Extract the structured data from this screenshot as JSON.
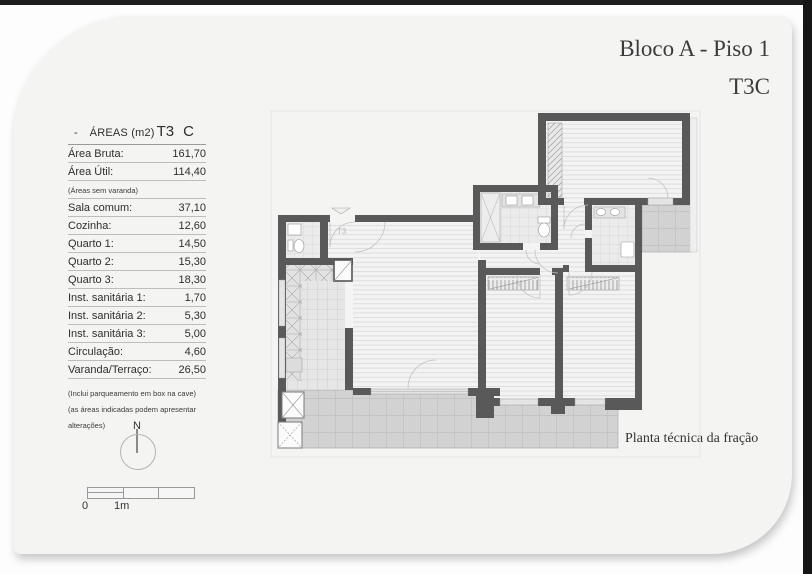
{
  "page": {
    "title_line1": "Bloco A - Piso 1",
    "title_line2": "T3C",
    "plan_caption": "Planta técnica da fração"
  },
  "areas": {
    "dash": "-",
    "header_label": "ÁREAS (m2)",
    "header_type": "T3",
    "header_variant": "C",
    "rows": [
      {
        "label": "Área Bruta:",
        "value": "161,70"
      },
      {
        "label": "Área Útil:",
        "value": "114,40"
      },
      {
        "label": "Sala comum:",
        "value": "37,10"
      },
      {
        "label": "Cozinha:",
        "value": "12,60"
      },
      {
        "label": "Quarto 1:",
        "value": "14,50"
      },
      {
        "label": "Quarto 2:",
        "value": "15,30"
      },
      {
        "label": "Quarto 3:",
        "value": "18,30"
      },
      {
        "label": "Inst. sanitária 1:",
        "value": "1,70"
      },
      {
        "label": "Inst. sanitária 2:",
        "value": "5,30"
      },
      {
        "label": "Inst. sanitária 3:",
        "value": "5,00"
      },
      {
        "label": "Circulação:",
        "value": "4,60"
      },
      {
        "label": "Varanda/Terraço:",
        "value": "26,50"
      }
    ],
    "note_top": "(Áreas sem varanda)",
    "note_bottom_1": "(Inclui parqueamento em box na cave)",
    "note_bottom_2": "(as áreas indicadas podem apresentar alterações)"
  },
  "compass": {
    "label": "N"
  },
  "scalebar": {
    "zero": "0",
    "one": "1m"
  },
  "plan": {
    "floor_label": "T3"
  },
  "colors": {
    "wall": "#595959",
    "sheet_bg": "#f4f4f3",
    "terrace": "#d2d2d2"
  }
}
